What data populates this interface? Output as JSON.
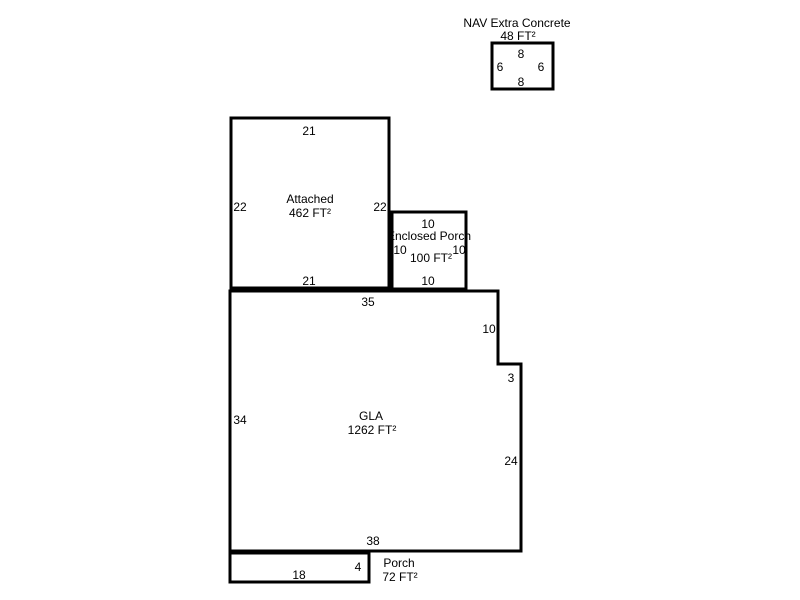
{
  "background": "#ffffff",
  "line_color": "#000000",
  "text_color": "#000000",
  "areas": {
    "nav_extra_concrete": {
      "label": "NAV Extra Concrete",
      "area": "48 FT²",
      "dim_top": "8",
      "dim_left": "6",
      "dim_right": "6",
      "dim_bottom": "8"
    },
    "attached": {
      "label": "Attached",
      "area": "462 FT²",
      "dim_top": "21",
      "dim_left": "22",
      "dim_right": "22",
      "dim_bottom": "21"
    },
    "enclosed_porch": {
      "label": "Enclosed Porch",
      "area": "100 FT²",
      "dim_top": "10",
      "dim_left": "10",
      "dim_right": "10",
      "dim_bottom": "10"
    },
    "gla": {
      "label": "GLA",
      "area": "1262 FT²",
      "dim_top": "35",
      "dim_upper_right": "10",
      "dim_step": "3",
      "dim_right": "24",
      "dim_bottom": "38",
      "dim_left": "34"
    },
    "porch": {
      "label": "Porch",
      "area": "72 FT²",
      "dim_bottom": "18",
      "dim_right": "4"
    }
  }
}
